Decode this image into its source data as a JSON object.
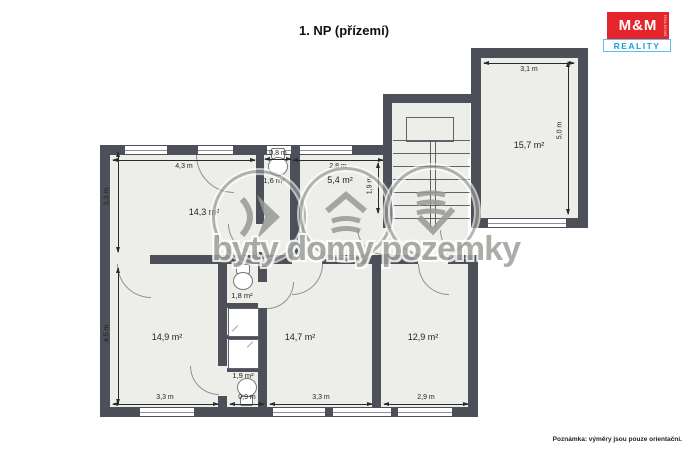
{
  "title": "1. NP (přízemí)",
  "note": "Poznámka: výměry jsou pouze orientační.",
  "logo": {
    "name": "M&M",
    "reality": "REALITY",
    "holding": "HOLDING"
  },
  "watermark": {
    "text": "byty domy pozemky",
    "icons": [
      "waves-chevron-icon",
      "house-icon",
      "land-icon"
    ]
  },
  "colors": {
    "wall": "#4d5058",
    "floor": "#edeee9",
    "accent_red": "#e4252b",
    "accent_blue": "#1d9ed8",
    "watermark_gray": "#9da09a"
  },
  "rooms": [
    {
      "key": "room-15-7",
      "area": "15,7 m²",
      "width": "3,1 m",
      "height": "5,0 m"
    },
    {
      "key": "room-14-3",
      "area": "14,3 m²",
      "width": "4,3 m",
      "height": "3,3 m"
    },
    {
      "key": "wc-1-6",
      "area": "1,6 m²",
      "width": "0,8 m"
    },
    {
      "key": "room-5-4",
      "area": "5,4 m²",
      "width": "2,8 m",
      "height": "1,9 m"
    },
    {
      "key": "room-14-9",
      "area": "14,9 m²",
      "width": "3,3 m",
      "height": "4,5 m"
    },
    {
      "key": "wc-1-8",
      "area": "1,8 m²"
    },
    {
      "key": "wc-1-9",
      "area": "1,9 m²",
      "width": "0,9 m"
    },
    {
      "key": "room-14-7",
      "area": "14,7 m²",
      "width": "3,3 m"
    },
    {
      "key": "room-12-9",
      "area": "12,9 m²",
      "width": "2,9 m"
    }
  ]
}
